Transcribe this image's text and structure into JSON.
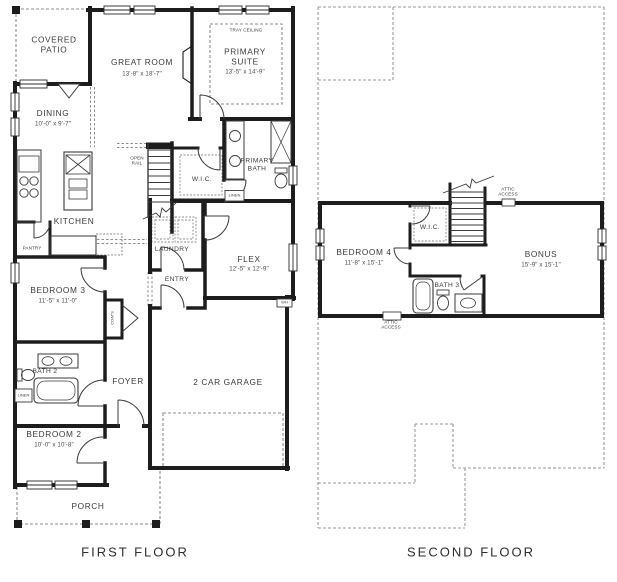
{
  "page": {
    "background": "#ffffff",
    "wall_color": "#1d1d1d",
    "dash_color": "#8c8c8c",
    "text_color": "#3b3b3b"
  },
  "first_floor": {
    "title": "FIRST FLOOR",
    "covered_patio": {
      "label": "COVERED\nPATIO"
    },
    "great_room": {
      "label": "GREAT ROOM",
      "dims": "13'-8\" x 18'-7\""
    },
    "primary_suite": {
      "label": "PRIMARY\nSUITE",
      "dims": "13'-5\" x 14'-9\"",
      "ceiling": "TRAY CEILING"
    },
    "dining": {
      "label": "DINING",
      "dims": "10'-0\" x 9'-7\""
    },
    "open_rail": {
      "label": "OPEN\nRAIL"
    },
    "kitchen": {
      "label": "KITCHEN"
    },
    "pantry": {
      "label": "PANTRY"
    },
    "wic": {
      "label": "W.I.C."
    },
    "linen_wic": {
      "label": "LINEN"
    },
    "primary_bath": {
      "label": "PRIMARY\nBATH"
    },
    "laundry": {
      "label": "LAUNDRY"
    },
    "flex": {
      "label": "FLEX",
      "dims": "12'-5\" x 12'-9\""
    },
    "entry": {
      "label": "ENTRY"
    },
    "bedroom3": {
      "label": "BEDROOM 3",
      "dims": "11'-5\" x 11'-0\""
    },
    "coats": {
      "label": "COATS"
    },
    "bath2": {
      "label": "BATH 2"
    },
    "linen_bath2": {
      "label": "LINEN"
    },
    "foyer": {
      "label": "FOYER"
    },
    "bedroom2": {
      "label": "BEDROOM 2",
      "dims": "10'-0\" x 10'-8\""
    },
    "garage": {
      "label": "2 CAR GARAGE"
    },
    "water_heater": {
      "label": "WH"
    },
    "porch": {
      "label": "PORCH"
    }
  },
  "second_floor": {
    "title": "SECOND FLOOR",
    "attic_access_top": {
      "label": "ATTIC\nACCESS"
    },
    "attic_access_bottom": {
      "label": "ATTIC\nACCESS"
    },
    "wic": {
      "label": "W.I.C."
    },
    "bedroom4": {
      "label": "BEDROOM 4",
      "dims": "11'-8\" x 15'-1\""
    },
    "bonus": {
      "label": "BONUS",
      "dims": "15'-9\" x 15'-1\""
    },
    "bath3": {
      "label": "BATH 3"
    }
  }
}
